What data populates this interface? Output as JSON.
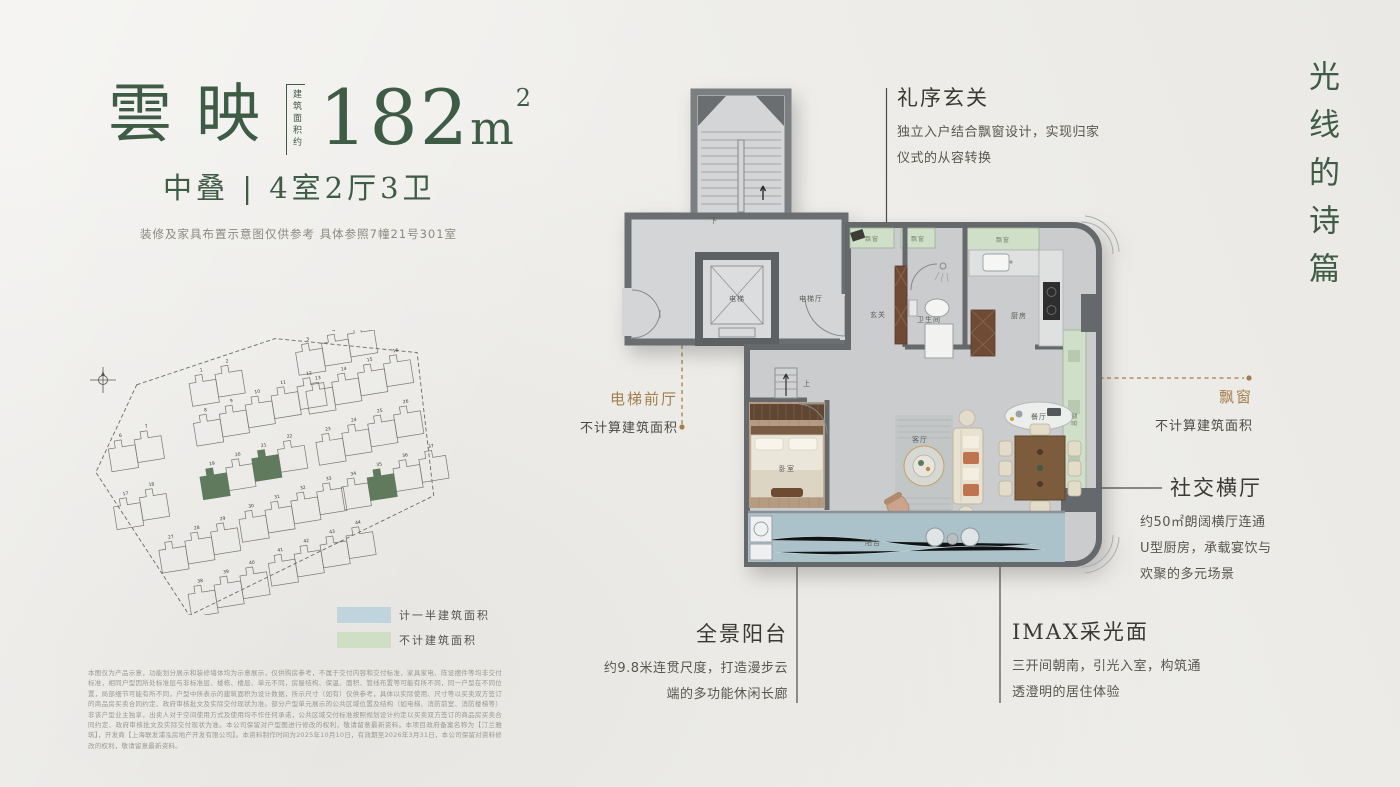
{
  "header": {
    "name": "雲映",
    "area_label": "建筑面积约",
    "area_value": "182",
    "area_unit": "m",
    "area_sup": "2",
    "subtitle": "中叠 | 4室2厅3卫",
    "note": "装修及家具布置示意图仅供参考 具体参照7幢21号301室"
  },
  "side_title": "光线的诗篇",
  "legend": [
    {
      "label": "计一半建筑面积",
      "color": "#bfd4dd"
    },
    {
      "label": "不计建筑面积",
      "color": "#cfdfc6"
    }
  ],
  "annotations": {
    "entry": {
      "title": "礼序玄关",
      "line1": "独立入户结合飘窗设计，实现归家",
      "line2": "仪式的从容转换"
    },
    "lift": {
      "title": "电梯前厅",
      "desc": "不计算建筑面积"
    },
    "bay": {
      "title": "飘窗",
      "desc": "不计算建筑面积"
    },
    "social": {
      "title": "社交横厅",
      "line1": "约50㎡朗阔横厅连通",
      "line2": "U型厨房，承载宴饮与",
      "line3": "欢聚的多元场景"
    },
    "balcony": {
      "title": "全景阳台",
      "line1": "约9.8米连贯尺度，打造漫步云",
      "line2": "端的多功能休闲长廊"
    },
    "imax": {
      "title": "IMAX采光面",
      "line1": "三开间朝南，引光入室，构筑通",
      "line2": "透澄明的居住体验"
    }
  },
  "plan": {
    "down": "下",
    "up": "上",
    "lift": "电梯",
    "lift_hall": "电梯厅",
    "foyer": "玄关",
    "bath": "卫生间",
    "kitchen": "厨房",
    "living": "客厅",
    "dining": "餐厅",
    "bed": "卧室",
    "balcony": "阳台",
    "bay": "飘窗"
  },
  "site_plan": {
    "building_numbers": [
      1,
      2,
      3,
      4,
      5,
      6,
      7,
      8,
      9,
      10,
      11,
      12,
      13,
      14,
      15,
      16,
      17,
      18,
      19,
      20,
      21,
      22,
      23,
      24,
      25,
      26,
      27,
      28,
      29,
      30,
      31,
      32,
      33,
      34,
      35,
      36,
      37,
      38,
      39,
      40,
      41,
      42,
      43,
      44
    ],
    "highlighted": [
      19,
      21,
      35
    ],
    "highlight_color": "#5f7a5c"
  },
  "disclaimer": "本图仅为产品示意，功能划分展示和装修墙体均为示意展示，仅供购房参考，不属于交付内容和交付标准，家具家电、陈设摆件等均非交付标准，相同户型因所处标准层与非标准层、楼栋、楼层、单元不同，房屋结构、保温、面积、管线布置等可能有所不同，同一户型在不同位置，局部细节可能有所不同，户型中所表示的建筑面积为设计数据，所示尺寸（如有）仅供参考，具体以实际使用、尺寸等以买卖双方签订的商品房买卖合同约定、政府审核批文及实际交付现状为准。部分户型单元展示的公共区域位置及结构（如电梯、消防前室、消防楼梯等）非该户型业主独享，出卖人对于空间使用方式及使用均不作任何承诺，公共区域交付标准按照规划设计约定以买卖双方签订的商品房买卖合同约定、政府审核批文及实际交付现状为准。本公司保留对户型图进行修改的权利，敬请留意最新资料。本项目政府备案名称为【汀兰雅筑】，开发商【上海联发浦泓房地产开发有限公司】。本资料制作时间为2025年10月10日，有效期至2026年3月31日，本公司保留对资料修改的权利，敬请留意最新资料。"
}
